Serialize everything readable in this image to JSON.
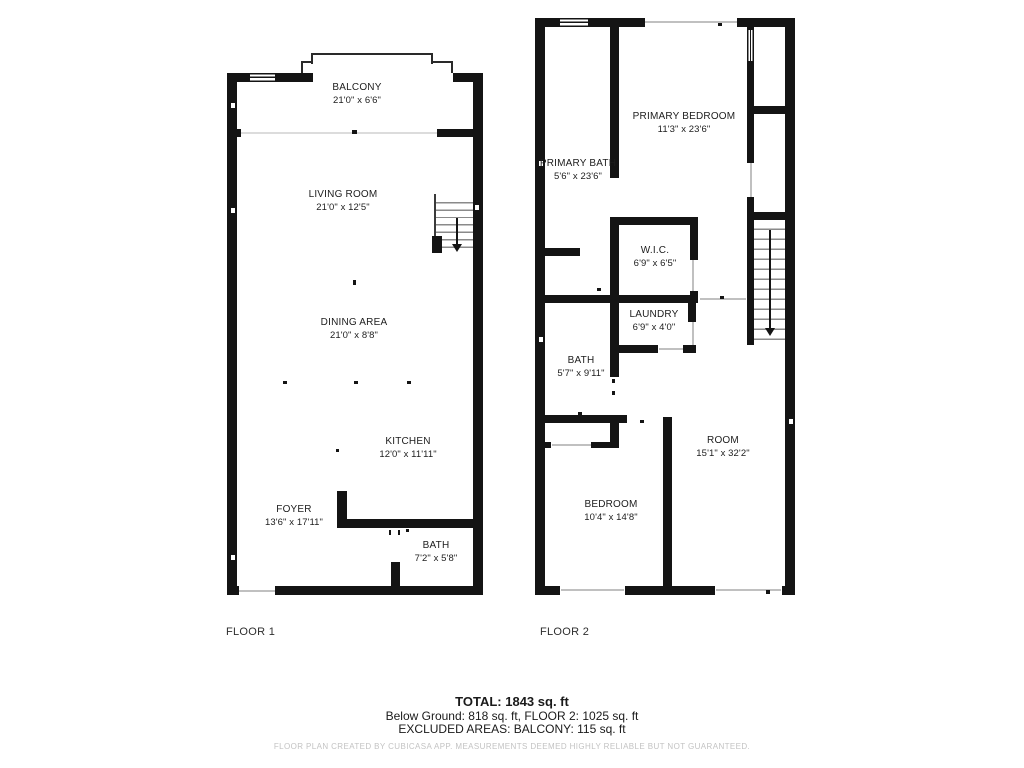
{
  "floor1": {
    "label": "FLOOR 1",
    "rooms": [
      {
        "name": "BALCONY",
        "dims": "21'0\" x 6'6\""
      },
      {
        "name": "LIVING ROOM",
        "dims": "21'0\" x 12'5\""
      },
      {
        "name": "DINING AREA",
        "dims": "21'0\" x 8'8\""
      },
      {
        "name": "KITCHEN",
        "dims": "12'0\" x 11'11\""
      },
      {
        "name": "FOYER",
        "dims": "13'6\" x 17'11\""
      },
      {
        "name": "BATH",
        "dims": "7'2\" x 5'8\""
      }
    ]
  },
  "floor2": {
    "label": "FLOOR 2",
    "rooms": [
      {
        "name": "PRIMARY BEDROOM",
        "dims": "11'3\" x 23'6\""
      },
      {
        "name": "PRIMARY BATH",
        "dims": "5'6\" x 23'6\""
      },
      {
        "name": "W.I.C.",
        "dims": "6'9\" x 6'5\""
      },
      {
        "name": "LAUNDRY",
        "dims": "6'9\" x 4'0\""
      },
      {
        "name": "BATH",
        "dims": "5'7\" x 9'11\""
      },
      {
        "name": "BEDROOM",
        "dims": "10'4\" x 14'8\""
      },
      {
        "name": "ROOM",
        "dims": "15'1\" x 32'2\""
      }
    ]
  },
  "summary": {
    "total": "TOTAL: 1843 sq. ft",
    "breakdown": "Below Ground: 818 sq. ft, FLOOR 2: 1025 sq. ft",
    "excluded": "EXCLUDED AREAS: BALCONY: 115 sq. ft",
    "disclaimer": "FLOOR PLAN CREATED BY CUBICASA APP. MEASUREMENTS DEEMED HIGHLY RELIABLE BUT NOT GUARANTEED."
  }
}
